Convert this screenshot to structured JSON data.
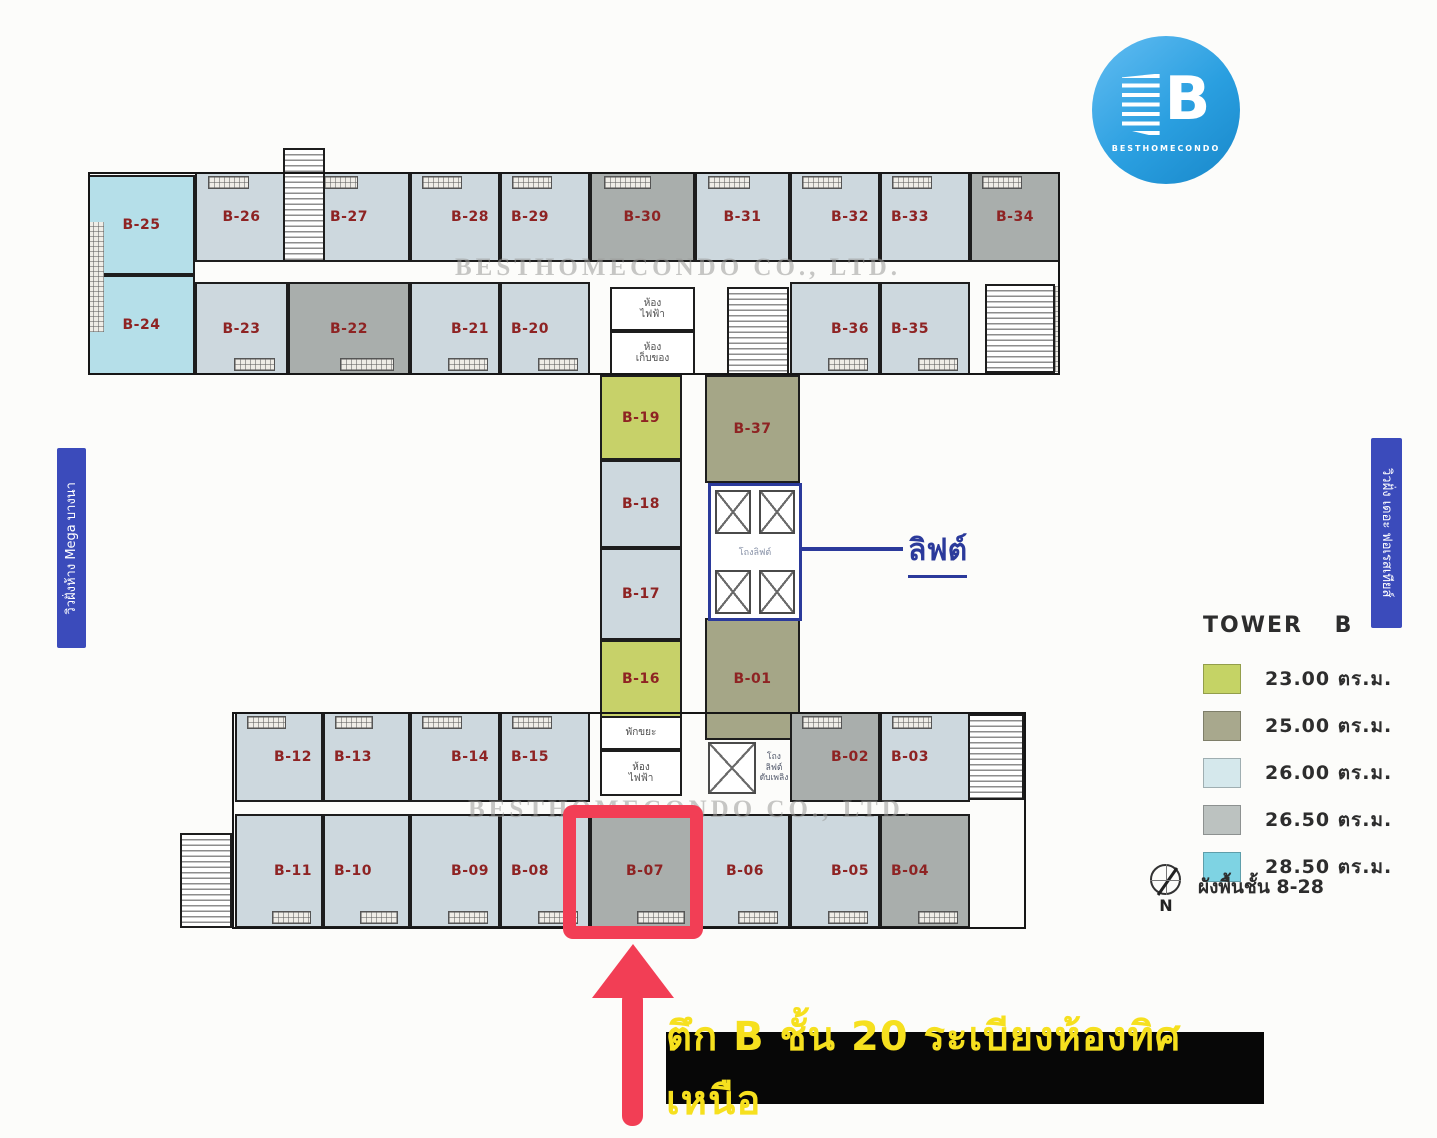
{
  "logo": {
    "letter": "B",
    "brand": "BESTHOMECONDO"
  },
  "side_labels": {
    "left": "วิวฝั่งห้าง Mega บางนา",
    "right": "วิวฝั่ง เดอะ ฟอเรสเทียส์"
  },
  "watermark": {
    "text": "BESTHOMECONDO CO., LTD."
  },
  "elevator": {
    "callout": "ลิฟต์",
    "lobby": "โถงลิฟต์"
  },
  "legend": {
    "title": "TOWER B",
    "items": [
      {
        "area": "23.00 ตร.ม.",
        "color": "#c5d365"
      },
      {
        "area": "25.00 ตร.ม.",
        "color": "#a8a88d"
      },
      {
        "area": "26.00 ตร.ม.",
        "color": "#d5e8ec"
      },
      {
        "area": "26.50 ตร.ม.",
        "color": "#bcc2c0"
      },
      {
        "area": "28.50 ตร.ม.",
        "color": "#7ed3e3"
      }
    ],
    "floor_note": "ผังพื้นชั้น 8-28",
    "compass_letter": "N"
  },
  "banner": {
    "text": "ตึก B ชั้น 20 ระเบียงห้องทิศเหนือ"
  },
  "highlight": {
    "unit": "B-07"
  },
  "unit_colors": {
    "23.00": "#c7d169",
    "25.00": "#a5a687",
    "26.00": "#cdd8de",
    "26.50": "#a9aeac",
    "28.50": "#b5dfe9"
  },
  "units": [
    {
      "label": "B-26",
      "size": "26.00",
      "x": 195,
      "y": 172,
      "w": 93,
      "h": 90,
      "hb": "t"
    },
    {
      "label": "B-27",
      "size": "26.00",
      "x": 288,
      "y": 172,
      "w": 122,
      "h": 90,
      "hb": "t"
    },
    {
      "label": "B-28",
      "size": "26.00",
      "x": 410,
      "y": 172,
      "w": 90,
      "h": 90,
      "hb": "t",
      "lp": "r"
    },
    {
      "label": "B-29",
      "size": "26.00",
      "x": 500,
      "y": 172,
      "w": 90,
      "h": 90,
      "hb": "t",
      "lp": "l"
    },
    {
      "label": "B-30",
      "size": "26.50",
      "x": 590,
      "y": 172,
      "w": 105,
      "h": 90,
      "hb": "t"
    },
    {
      "label": "B-31",
      "size": "26.00",
      "x": 695,
      "y": 172,
      "w": 95,
      "h": 90,
      "hb": "t"
    },
    {
      "label": "B-32",
      "size": "26.00",
      "x": 790,
      "y": 172,
      "w": 90,
      "h": 90,
      "hb": "t",
      "lp": "r"
    },
    {
      "label": "B-33",
      "size": "26.00",
      "x": 880,
      "y": 172,
      "w": 90,
      "h": 90,
      "hb": "t",
      "lp": "l"
    },
    {
      "label": "B-34",
      "size": "26.50",
      "x": 970,
      "y": 172,
      "w": 90,
      "h": 90,
      "hb": "t"
    },
    {
      "label": "B-23",
      "size": "26.00",
      "x": 195,
      "y": 282,
      "w": 93,
      "h": 93,
      "hb": "b"
    },
    {
      "label": "B-22",
      "size": "26.50",
      "x": 288,
      "y": 282,
      "w": 122,
      "h": 93,
      "hb": "b"
    },
    {
      "label": "B-21",
      "size": "26.00",
      "x": 410,
      "y": 282,
      "w": 90,
      "h": 93,
      "hb": "b",
      "lp": "r"
    },
    {
      "label": "B-20",
      "size": "26.00",
      "x": 500,
      "y": 282,
      "w": 90,
      "h": 93,
      "hb": "b",
      "lp": "l"
    },
    {
      "label": "B-36",
      "size": "26.00",
      "x": 790,
      "y": 282,
      "w": 90,
      "h": 93,
      "hb": "b",
      "lp": "r"
    },
    {
      "label": "B-35",
      "size": "26.00",
      "x": 880,
      "y": 282,
      "w": 90,
      "h": 93,
      "hb": "b",
      "lp": "l"
    },
    {
      "label": "B-25",
      "size": "28.50",
      "x": 88,
      "y": 175,
      "w": 107,
      "h": 100
    },
    {
      "label": "B-24",
      "size": "28.50",
      "x": 88,
      "y": 275,
      "w": 107,
      "h": 100
    },
    {
      "label": "B-19",
      "size": "23.00",
      "x": 600,
      "y": 375,
      "w": 82,
      "h": 85
    },
    {
      "label": "B-18",
      "size": "26.00",
      "x": 600,
      "y": 460,
      "w": 82,
      "h": 88
    },
    {
      "label": "B-17",
      "size": "26.00",
      "x": 600,
      "y": 548,
      "w": 82,
      "h": 92
    },
    {
      "label": "B-16",
      "size": "23.00",
      "x": 600,
      "y": 640,
      "w": 82,
      "h": 78
    },
    {
      "label": "B-37",
      "size": "25.00",
      "x": 705,
      "y": 375,
      "w": 95,
      "h": 108
    },
    {
      "label": "B-01",
      "size": "25.00",
      "x": 705,
      "y": 618,
      "w": 95,
      "h": 122
    },
    {
      "label": "B-12",
      "size": "26.00",
      "x": 235,
      "y": 712,
      "w": 88,
      "h": 90,
      "hb": "t",
      "lp": "r"
    },
    {
      "label": "B-13",
      "size": "26.00",
      "x": 323,
      "y": 712,
      "w": 87,
      "h": 90,
      "hb": "t",
      "lp": "l"
    },
    {
      "label": "B-14",
      "size": "26.00",
      "x": 410,
      "y": 712,
      "w": 90,
      "h": 90,
      "hb": "t",
      "lp": "r"
    },
    {
      "label": "B-15",
      "size": "26.00",
      "x": 500,
      "y": 712,
      "w": 90,
      "h": 90,
      "hb": "t",
      "lp": "l"
    },
    {
      "label": "B-02",
      "size": "26.50",
      "x": 790,
      "y": 712,
      "w": 90,
      "h": 90,
      "hb": "t",
      "lp": "r"
    },
    {
      "label": "B-03",
      "size": "26.00",
      "x": 880,
      "y": 712,
      "w": 90,
      "h": 90,
      "hb": "t",
      "lp": "l"
    },
    {
      "label": "B-11",
      "size": "26.00",
      "x": 235,
      "y": 814,
      "w": 88,
      "h": 114,
      "hb": "b",
      "lp": "r"
    },
    {
      "label": "B-10",
      "size": "26.00",
      "x": 323,
      "y": 814,
      "w": 87,
      "h": 114,
      "hb": "b",
      "lp": "l"
    },
    {
      "label": "B-09",
      "size": "26.00",
      "x": 410,
      "y": 814,
      "w": 90,
      "h": 114,
      "hb": "b",
      "lp": "r"
    },
    {
      "label": "B-08",
      "size": "26.00",
      "x": 500,
      "y": 814,
      "w": 90,
      "h": 114,
      "hb": "b",
      "lp": "l"
    },
    {
      "label": "B-07",
      "size": "26.50",
      "x": 590,
      "y": 814,
      "w": 110,
      "h": 114,
      "hb": "b"
    },
    {
      "label": "B-06",
      "size": "26.00",
      "x": 700,
      "y": 814,
      "w": 90,
      "h": 114,
      "hb": "b"
    },
    {
      "label": "B-05",
      "size": "26.00",
      "x": 790,
      "y": 814,
      "w": 90,
      "h": 114,
      "hb": "b",
      "lp": "r"
    },
    {
      "label": "B-04",
      "size": "26.50",
      "x": 880,
      "y": 814,
      "w": 90,
      "h": 114,
      "hb": "b",
      "lp": "l"
    }
  ],
  "structures": [
    {
      "kind": "hatch",
      "x": 88,
      "y": 222,
      "w": 16,
      "h": 110
    },
    {
      "kind": "hatch",
      "x": 1040,
      "y": 286,
      "w": 18,
      "h": 86
    },
    {
      "kind": "stair",
      "x": 283,
      "y": 148,
      "w": 42,
      "h": 114
    },
    {
      "kind": "stair",
      "x": 727,
      "y": 287,
      "w": 62,
      "h": 88
    },
    {
      "kind": "stair",
      "x": 985,
      "y": 284,
      "w": 70,
      "h": 89
    },
    {
      "kind": "stair",
      "x": 968,
      "y": 714,
      "w": 56,
      "h": 86
    },
    {
      "kind": "stair",
      "x": 180,
      "y": 833,
      "w": 52,
      "h": 95
    },
    {
      "kind": "room",
      "x": 610,
      "y": 287,
      "w": 85,
      "h": 44,
      "label": "ห้อง\nไฟฟ้า"
    },
    {
      "kind": "room",
      "x": 610,
      "y": 331,
      "w": 85,
      "h": 44,
      "label": "ห้อง\nเก็บของ"
    },
    {
      "kind": "room",
      "x": 600,
      "y": 716,
      "w": 82,
      "h": 34,
      "label": "พักขยะ"
    },
    {
      "kind": "room",
      "x": 600,
      "y": 750,
      "w": 82,
      "h": 46,
      "label": "ห้อง\nไฟฟ้า"
    },
    {
      "kind": "shaft",
      "x": 708,
      "y": 742,
      "w": 48,
      "h": 52
    },
    {
      "kind": "note",
      "x": 756,
      "y": 742,
      "w": 36,
      "h": 52,
      "label": "โถง\nลิฟต์\nดับเพลิง"
    },
    {
      "kind": "outline",
      "x": 88,
      "y": 172,
      "w": 972,
      "h": 203
    },
    {
      "kind": "outline",
      "x": 232,
      "y": 712,
      "w": 794,
      "h": 217
    }
  ]
}
